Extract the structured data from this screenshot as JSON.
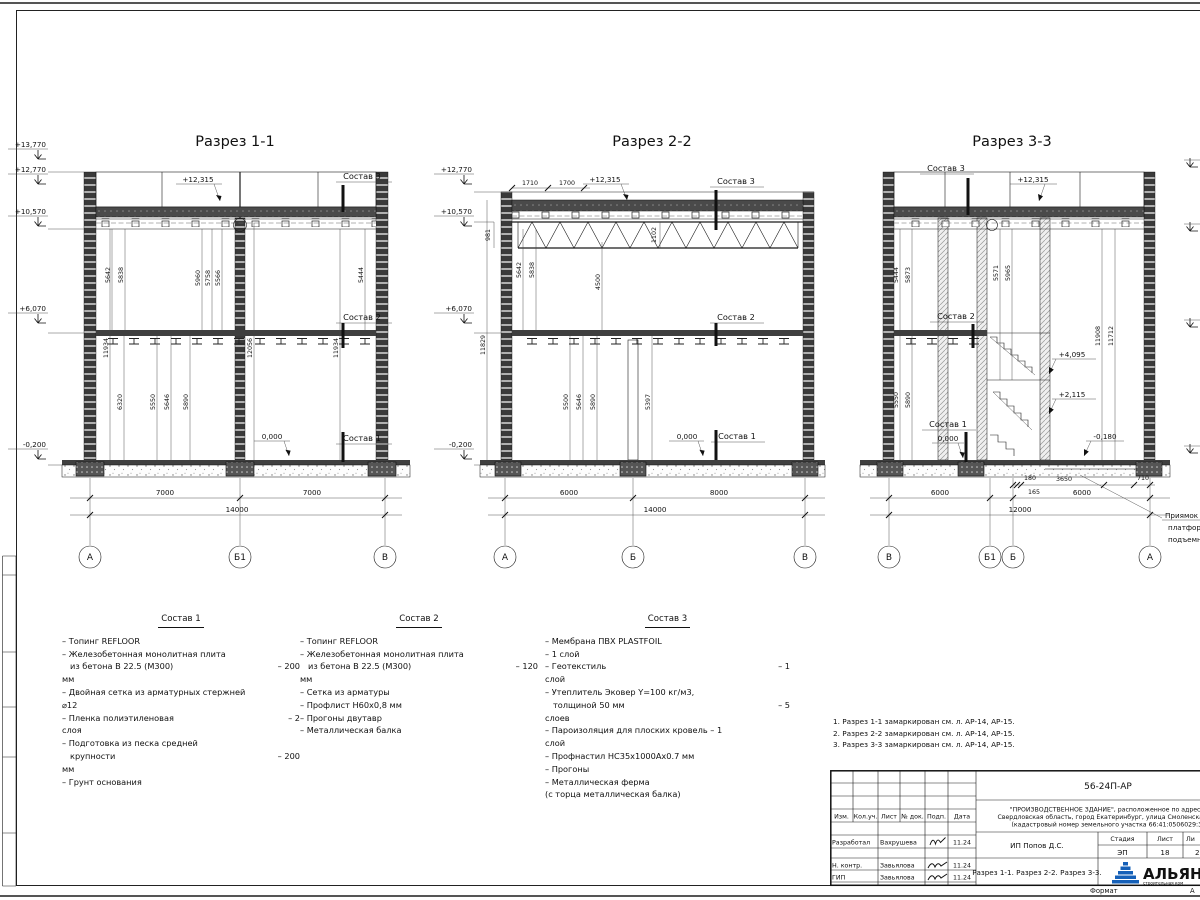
{
  "sheet": {
    "format_label": "Формат",
    "format_value": "А",
    "notes": [
      "1. Разрез 1-1 замаркирован см. л. АР-14, АР-15.",
      "2. Разрез 2-2 замаркирован см. л. АР-14, АР-15.",
      "3. Разрез 3-3 замаркирован см. л. АР-14, АР-15."
    ],
    "stamp": {
      "doc_number": "56-24П-АР",
      "project_lines": [
        "\"ПРОИЗВОДСТВЕННОЕ ЗДАНИЕ\", расположенное по адресу:",
        "Свердловская область, город Екатеринбург, улица Смоленская, 22",
        "(кадастровый номер земельного участка 66:41:0506029:3)"
      ],
      "header_cols": [
        "Изм.",
        "Кол.уч.",
        "Лист",
        "№ док.",
        "Подп.",
        "Дата"
      ],
      "rows": [
        {
          "role": "Разработал",
          "name": "Вахрушева",
          "date": "11.24"
        },
        {
          "role": "Н. контр.",
          "name": "Завьялова",
          "date": "11.24"
        },
        {
          "role": "ГИП",
          "name": "Завьялова",
          "date": "11.24"
        }
      ],
      "client": "ИП Попов Д.С.",
      "sheet_title": "Разрез 1-1. Разрез 2-2. Разрез 3-3.",
      "stage_label": "Стадия",
      "sheet_label": "Лист",
      "sheets_label": "Ли",
      "stage": "ЭП",
      "sheet_no": "18",
      "sheets_total": "2",
      "logo_text": "АЛЬЯН",
      "logo_sub": "строительная ком"
    }
  },
  "sections": [
    {
      "title": "Разрез 1-1",
      "elev": {
        "e13770": "+13,770",
        "e12770": "+12,770",
        "e10570": "+10,570",
        "e6070": "+6,070",
        "em0200": "-0,200"
      },
      "roof_elev": "+12,315",
      "lab_sostav3": "Состав 3",
      "lab_sostav2": "Состав 2",
      "lab_sostav1": "Состав 1",
      "zero": "0,000",
      "vu": [
        "5642",
        "5838",
        "5960",
        "5758",
        "5566",
        "5444"
      ],
      "vt": [
        "11934",
        "12056",
        "11934"
      ],
      "vl": [
        "6320",
        "5550",
        "5646",
        "5890"
      ],
      "db": [
        "7000",
        "7000"
      ],
      "dt": "14000",
      "axes": [
        "А",
        "Б1",
        "В"
      ]
    },
    {
      "title": "Разрез 2-2",
      "elev": {
        "e12770": "+12,770",
        "e10570": "+10,570",
        "e6070": "+6,070",
        "em0200": "-0,200"
      },
      "roof_elev": "+12,315",
      "top_dims": [
        "1710",
        "1700"
      ],
      "truss_dims": [
        "981",
        "1102"
      ],
      "lab_sostav3": "Состав 3",
      "lab_sostav2": "Состав 2",
      "lab_sostav1": "Состав 1",
      "zero": "0,000",
      "vu": [
        "5642",
        "5838",
        "4500"
      ],
      "vt": [
        "11829"
      ],
      "vl": [
        "5500",
        "5646",
        "5890",
        "5397"
      ],
      "db": [
        "6000",
        "8000"
      ],
      "dt": "14000",
      "axes": [
        "А",
        "Б",
        "В"
      ]
    },
    {
      "title": "Разрез 3-3",
      "roof_elev": "+12,315",
      "lab_sostav3": "Состав 3",
      "lab_sostav2": "Состав 2",
      "lab_sostav1": "Состав 1",
      "zero": "0,000",
      "vu": [
        "5444",
        "5873",
        "5571",
        "5965"
      ],
      "vt": [
        "11908",
        "11712"
      ],
      "vl": [
        "5550",
        "5890"
      ],
      "int_elev": [
        "+4,095",
        "+2,115"
      ],
      "minus": "-0,180",
      "small_dims": [
        "180",
        "165",
        "3650",
        "710"
      ],
      "db": [
        "6000",
        "6000"
      ],
      "dt": "12000",
      "axes": [
        "В",
        "Б1",
        "Б",
        "А"
      ],
      "callout": [
        "Приямок п",
        "платформ",
        "подъемни"
      ]
    }
  ],
  "sostav": [
    {
      "title": "Состав 1",
      "lines": [
        {
          "l": "– Топинг REFLOOR",
          "r": ""
        },
        {
          "l": "– Железобетонная  монолитная плита",
          "r": ""
        },
        {
          "l": "из бетона В 22.5 (М300)",
          "r": "– 200"
        },
        {
          "l": "мм",
          "r": ""
        },
        {
          "l": "– Двойная сетка из арматурных стержней",
          "r": ""
        },
        {
          "l": "⌀12",
          "r": ""
        },
        {
          "l": "– Пленка полиэтиленовая",
          "r": "–  2"
        },
        {
          "l": "слоя",
          "r": ""
        },
        {
          "l": "– Подготовка из песка средней",
          "r": ""
        },
        {
          "l": "крупности",
          "r": "– 200"
        },
        {
          "l": "мм",
          "r": ""
        },
        {
          "l": "– Грунт основания",
          "r": ""
        }
      ]
    },
    {
      "title": "Состав 2",
      "lines": [
        {
          "l": "– Топинг REFLOOR",
          "r": ""
        },
        {
          "l": "– Железобетонная  монолитная плита",
          "r": ""
        },
        {
          "l": "из бетона В 22.5 (М300)",
          "r": "– 120"
        },
        {
          "l": "мм",
          "r": ""
        },
        {
          "l": "– Сетка из арматуры",
          "r": ""
        },
        {
          "l": "– Профлист Н60х0,8 мм",
          "r": ""
        },
        {
          "l": "– Прогоны двутавр",
          "r": ""
        },
        {
          "l": "– Металлическая балка",
          "r": ""
        }
      ]
    },
    {
      "title": "Состав 3",
      "lines": [
        {
          "l": "– Мембрана ПВХ PLASTFOIL",
          "r": ""
        },
        {
          "l": "– 1 слой",
          "r": ""
        },
        {
          "l": "– Геотекстиль",
          "r": "– 1"
        },
        {
          "l": "слой",
          "r": ""
        },
        {
          "l": "– Утеплитель Эковер Y=100 кг/м3,",
          "r": ""
        },
        {
          "l": "толщиной 50 мм",
          "r": "– 5"
        },
        {
          "l": "слоев",
          "r": ""
        },
        {
          "l": "– Пароизоляция для плоских кровель – 1",
          "r": ""
        },
        {
          "l": "слой",
          "r": ""
        },
        {
          "l": "– Профнастил НС35х1000Ах0.7 мм",
          "r": ""
        },
        {
          "l": "– Прогоны",
          "r": ""
        },
        {
          "l": "– Металлическая ферма",
          "r": ""
        },
        {
          "l": "(с торца металлическая балка)",
          "r": ""
        }
      ]
    }
  ]
}
